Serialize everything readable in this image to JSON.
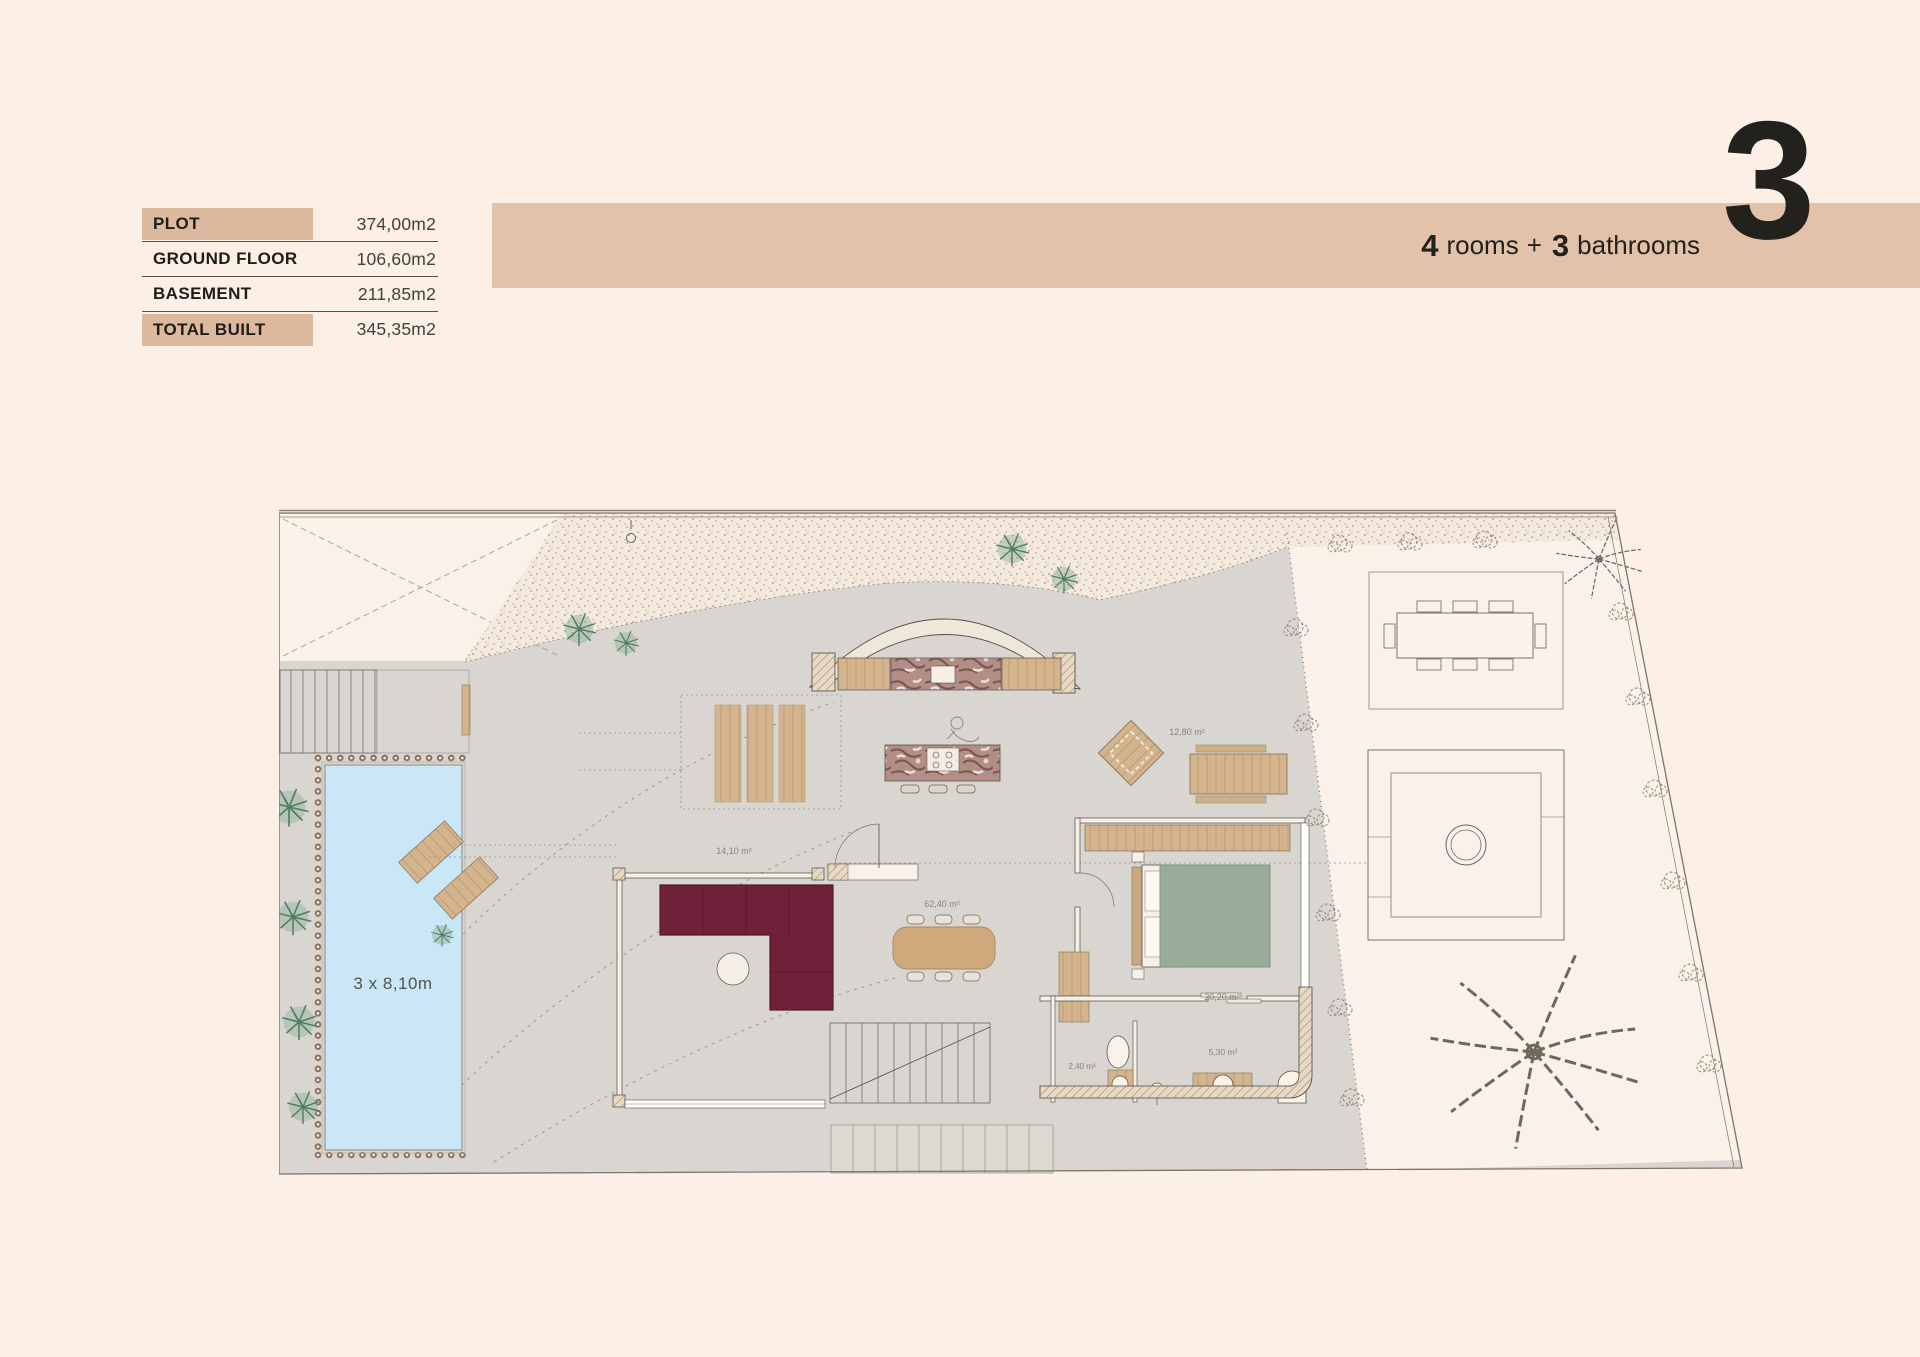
{
  "theme": {
    "page_bg": "#fbefe6",
    "banner_tan": "#e2c3aa",
    "highlight_tan": "#dcb99e",
    "ink": "#23211c",
    "value_ink": "#44403a",
    "plan_gray_floor": "#d9d6d1",
    "pool_blue": "#c9e7f6",
    "sofa_burgundy": "#6f2139",
    "bed_green": "#9aab9a",
    "wood_tan": "#d3b48d"
  },
  "spec_table": {
    "rows": [
      {
        "label": "PLOT",
        "value": "374,00m2",
        "highlighted": true
      },
      {
        "label": "GROUND FLOOR",
        "value": "106,60m2",
        "highlighted": false
      },
      {
        "label": "BASEMENT",
        "value": "211,85m2",
        "highlighted": false
      },
      {
        "label": "TOTAL BUILT",
        "value": "345,35m2",
        "highlighted": true
      }
    ]
  },
  "header": {
    "rooms_number": "4",
    "rooms_word": "rooms",
    "plus": "+",
    "bathrooms_number": "3",
    "bathrooms_word": "bathrooms",
    "floor_big_number": "3"
  },
  "floor_plan": {
    "pool": {
      "label": "3 x 8,10m"
    },
    "areas": {
      "covered_terrace": "14,10 m²",
      "living_kitchen": "62,40 m²",
      "outdoor_lounge": "12,80 m²",
      "bedroom": "20,20 m²",
      "bathroom": "5,30 m²",
      "toilet": "2,40 m²"
    }
  }
}
